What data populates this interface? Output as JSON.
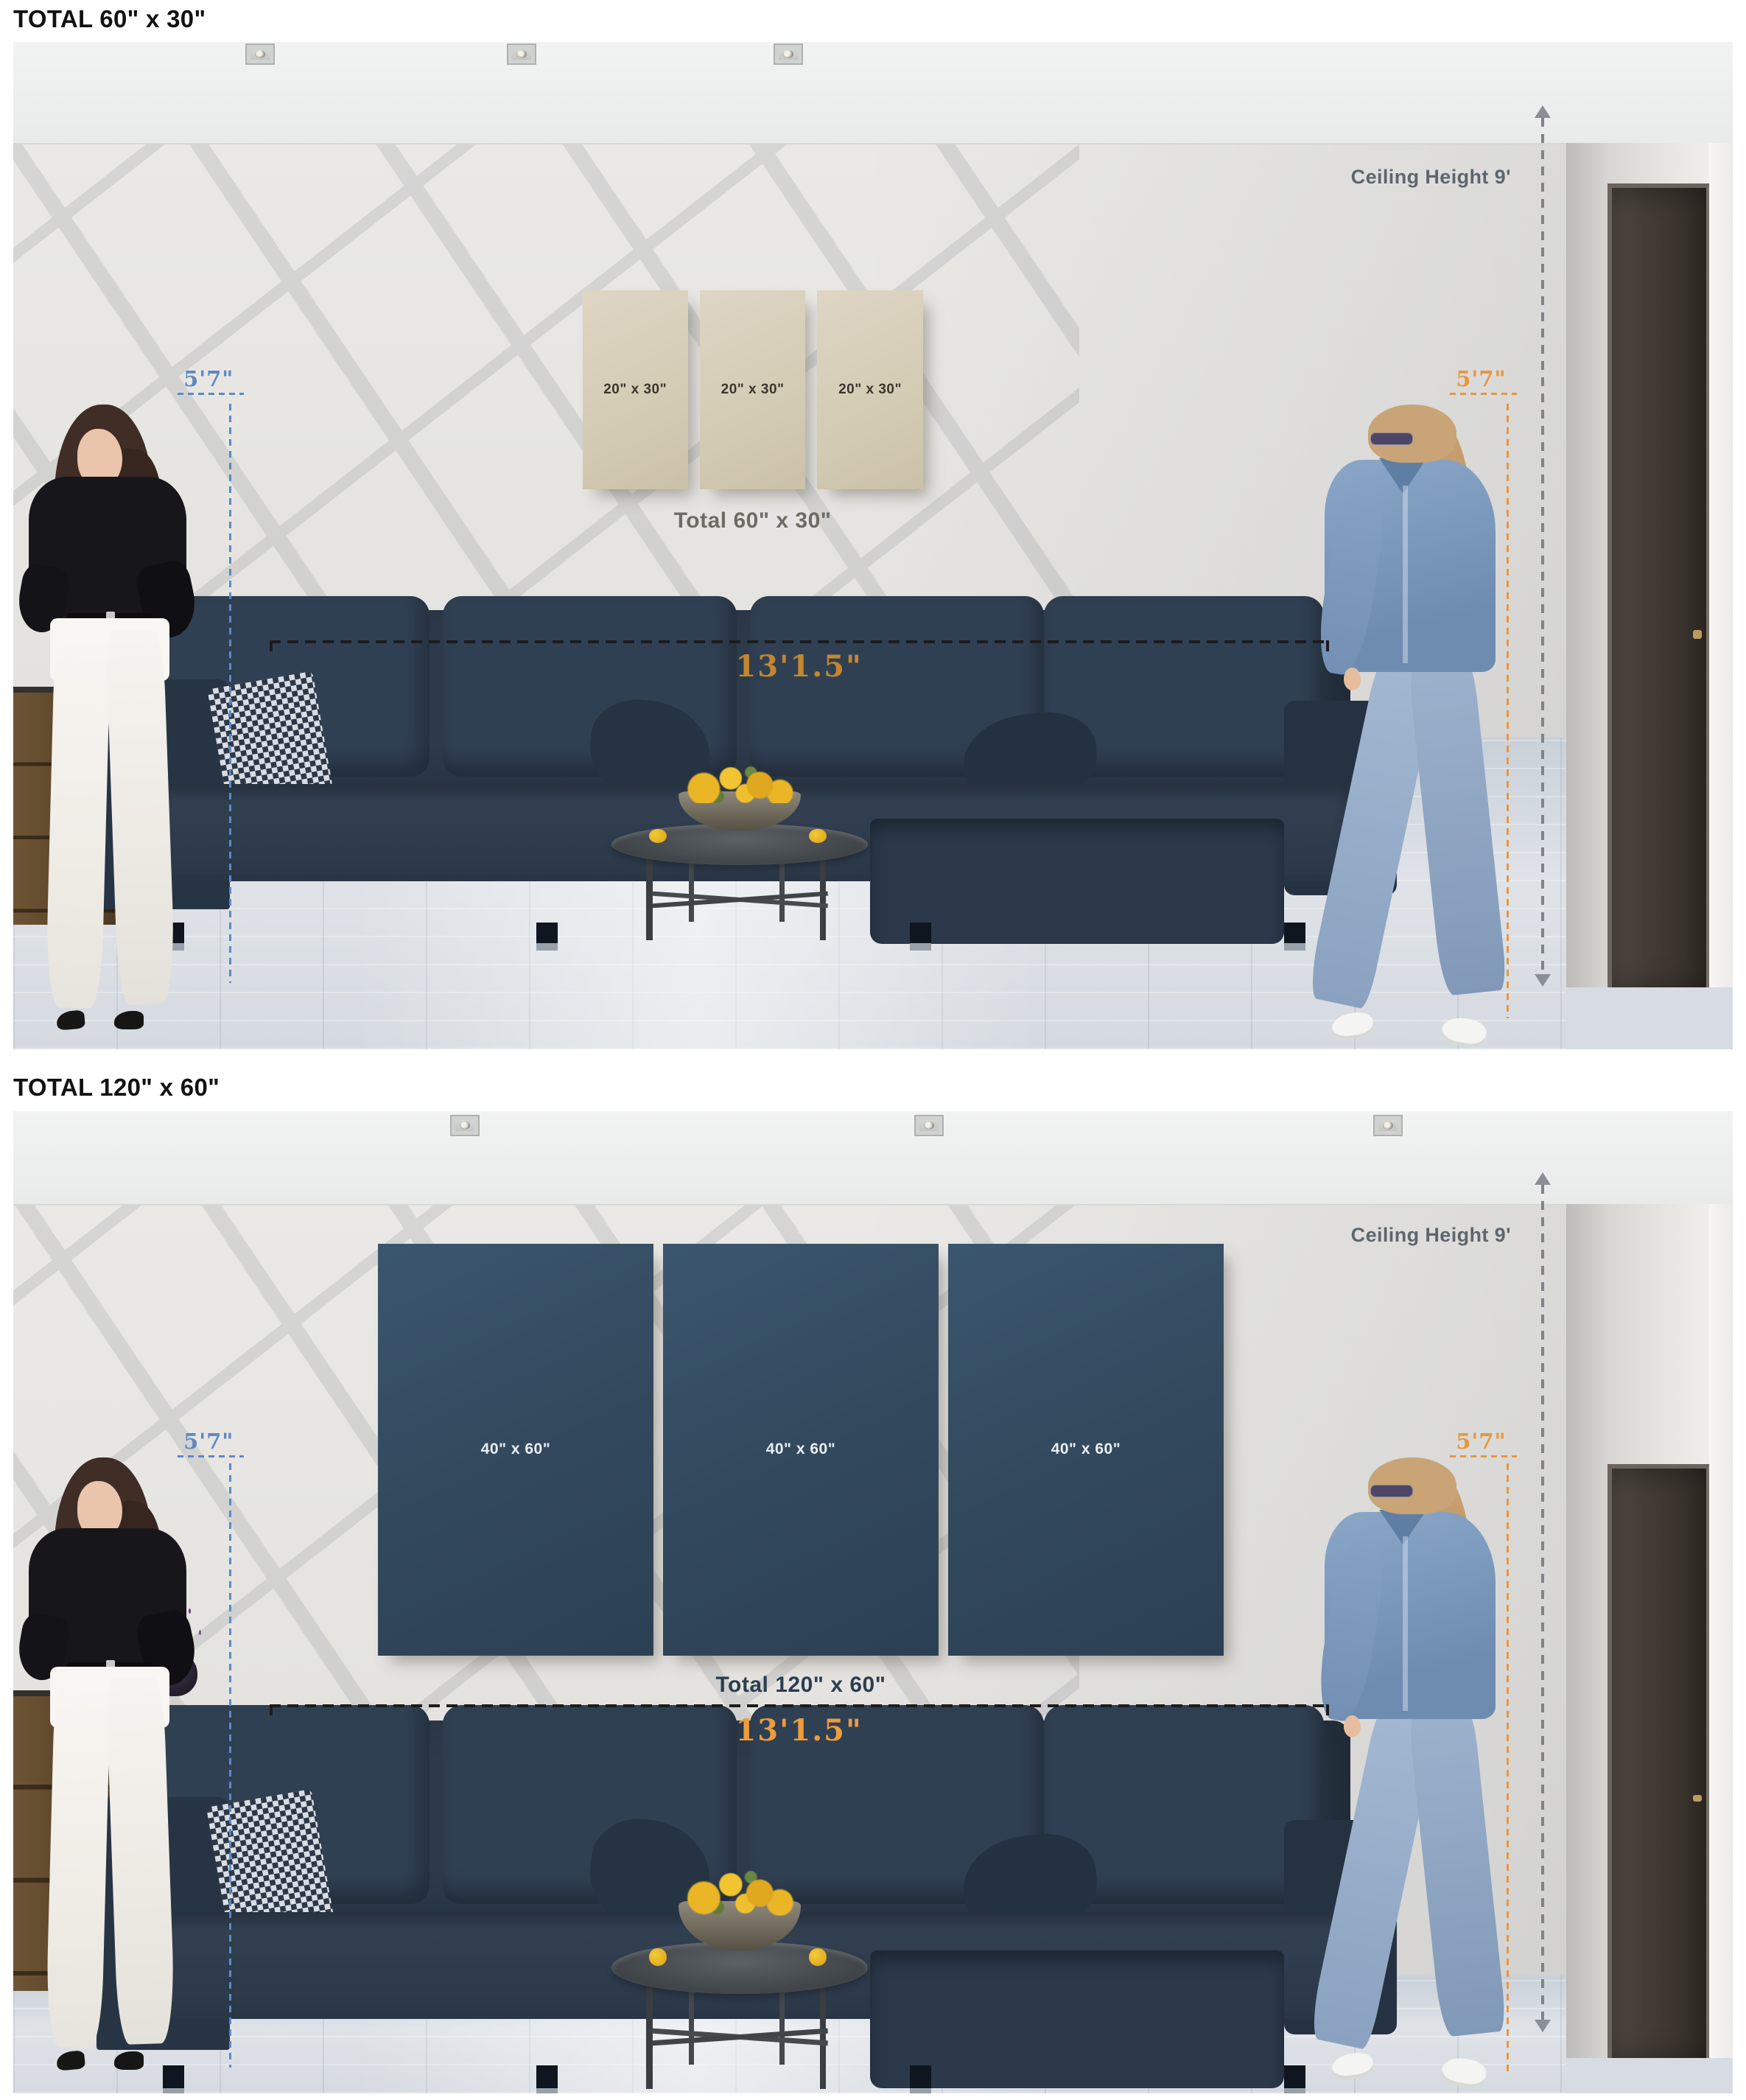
{
  "panels": [
    {
      "heading": "TOTAL 60\" x 30\"",
      "canvas_labels": [
        "20\" x 30\"",
        "20\" x 30\"",
        "20\" x 30\""
      ],
      "total_label": "Total 60\" x 30\"",
      "ceiling_label": "Ceiling Height 9'",
      "left_person_height": "5'7\"",
      "right_person_height": "5'7\"",
      "wall_width_label": "13'1.5\"",
      "canvas_color": "#d6cdb8",
      "canvas_text_color": "#3b352c",
      "total_label_color": "#6f6b64",
      "width_label_color": "#c5862f"
    },
    {
      "heading": "TOTAL 120\" x 60\"",
      "canvas_labels": [
        "40\" x 60\"",
        "40\" x 60\"",
        "40\" x 60\""
      ],
      "total_label": "Total 120\" x 60\"",
      "ceiling_label": "Ceiling Height 9'",
      "left_person_height": "5'7\"",
      "right_person_height": "5'7\"",
      "wall_width_label": "13'1.5\"",
      "canvas_color": "#33495c",
      "canvas_text_color": "#e9eef3",
      "total_label_color": "#2c3e50",
      "width_label_color": "#ee9c3c"
    }
  ],
  "colors": {
    "annotation_blue": "#5f88c2",
    "annotation_orange": "#e8963e",
    "annotation_gray": "#5d666e",
    "dashed_line_black": "#1c1c1c",
    "sofa_navy": "#2b3849",
    "wall_gray": "#e7e6e3",
    "floor_gray_blue": "#d9dee4"
  }
}
